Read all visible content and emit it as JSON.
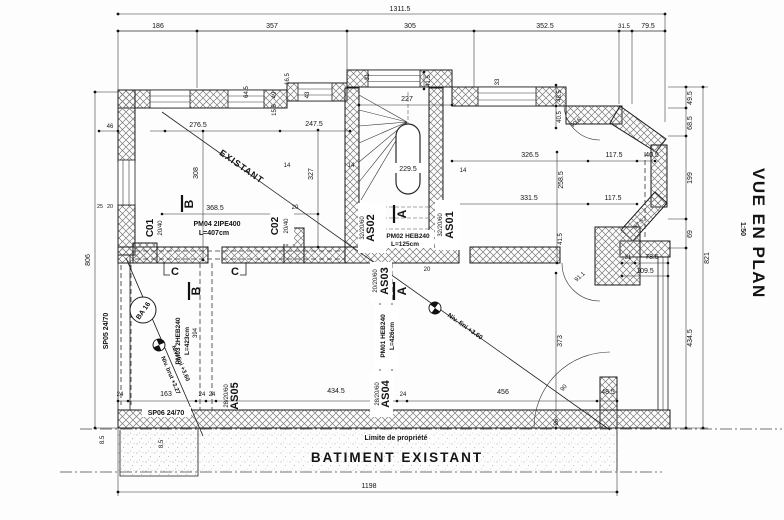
{
  "title": {
    "name": "VUE EN PLAN",
    "scale": "1:50"
  },
  "annotations": {
    "existant": "EXISTANT",
    "niv_fini": "Niv. fini +3.60",
    "niv_brut": "Niv. brut +3.27",
    "limite": "Limite de propriété",
    "batiment": "BATIMENT EXISTANT",
    "ba16": "BA 16"
  },
  "sections": {
    "a": "A",
    "b": "B",
    "c": "C"
  },
  "members": {
    "c01": {
      "id": "C01",
      "size": "20/40"
    },
    "c02": {
      "id": "C02",
      "size": "20/40"
    },
    "as01": {
      "id": "AS01",
      "size": "32/20/60"
    },
    "as02": {
      "id": "AS02",
      "size": "32/20/60"
    },
    "as03": {
      "id": "AS03",
      "size": "20/20/60"
    },
    "as04": {
      "id": "AS04",
      "size": "28/20/60"
    },
    "as05": {
      "id": "AS05",
      "size": "28/20/60"
    },
    "pm01": {
      "id": "PM01 HEB240",
      "len": "L=426cm"
    },
    "pm02": {
      "id": "PM02 HEB240",
      "len": "L=125cm"
    },
    "pm03": {
      "id": "PM03 2HEB240",
      "len": "L=423cm"
    },
    "pm04": {
      "id": "PM04 2IPE400",
      "len": "L=407cm"
    },
    "sp05": "SP05 24/70",
    "sp06": "SP06 24/70"
  },
  "dims": {
    "top_overall": "1311.5",
    "top": [
      "186",
      "357",
      "305",
      "352.5",
      "31.5",
      "79.5"
    ],
    "wall_top": [
      "16.5",
      "64.5",
      "49",
      "15.5",
      "43",
      "31",
      "41.5",
      "33"
    ],
    "right": [
      "49.5",
      "68.5",
      "199",
      "69",
      "434.5"
    ],
    "right_overall": "821",
    "left_overall": "806",
    "bottom": [
      "24",
      "163",
      "24",
      "24",
      "434.5",
      "24",
      "456",
      "48.5"
    ],
    "bottom_overall": "1198",
    "row_upper": [
      "276.5",
      "247.5"
    ],
    "row_r1": [
      "326.5",
      "117.5",
      "40.5"
    ],
    "row_r2": [
      "331.5",
      "117.5"
    ],
    "verticals": [
      "308",
      "327",
      "258.5",
      "373",
      "394",
      "41.5"
    ],
    "stair": [
      "227",
      "229.5"
    ],
    "small": [
      "14",
      "14",
      "14",
      "46",
      "25",
      "20",
      "20",
      "20",
      "8.5",
      "8.5",
      "26"
    ],
    "corner": [
      "31",
      "78.5",
      "109.5",
      "48.5",
      "40.5",
      "57.5"
    ],
    "angles": [
      "90.6",
      "91.1",
      "90"
    ],
    "misc": [
      "368.5"
    ]
  },
  "colors": {
    "line": "#1c1c1c",
    "hatch": "#7a7a7a"
  }
}
